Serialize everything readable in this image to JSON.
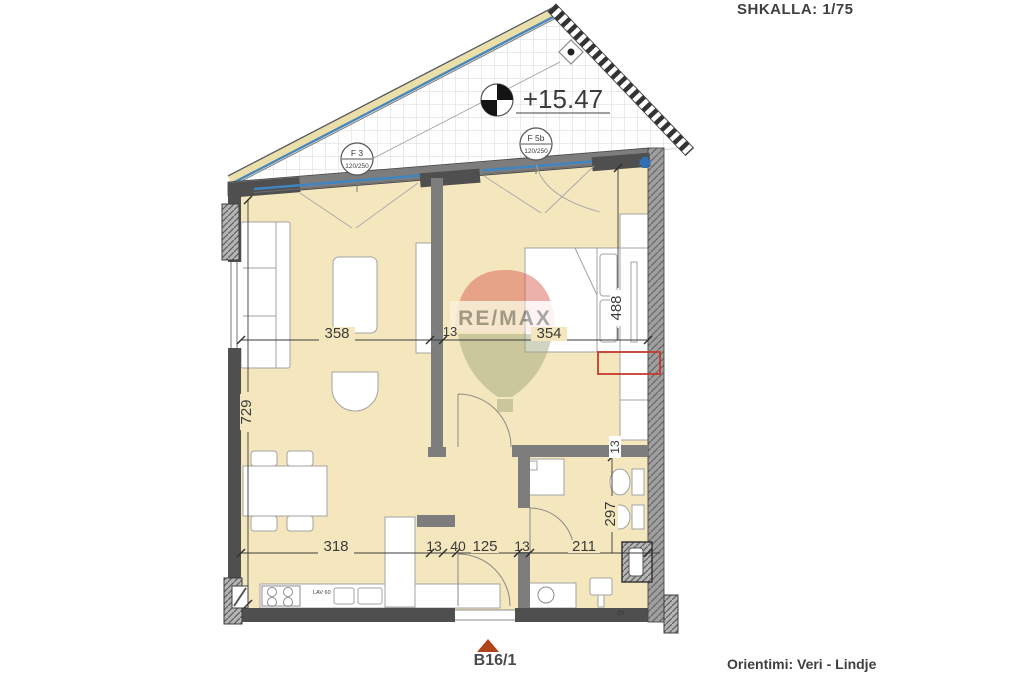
{
  "header": {
    "scale_label": "SHKALLA: 1/75"
  },
  "plan": {
    "elevation_label": "+15.47",
    "window_tags": [
      {
        "name": "F 3",
        "size": "120/250"
      },
      {
        "name": "F 5b",
        "size": "120/250"
      }
    ],
    "kitchen_counter_label": "LAV 60",
    "dimensions": {
      "upper_row": [
        "358",
        "13",
        "354"
      ],
      "lower_row": [
        "318",
        "13",
        "40",
        "125",
        "13",
        "211"
      ],
      "left_vertical": "729",
      "right_vertical_upper": "488",
      "right_vertical_lower": "297",
      "bath_wall_thickness": "13",
      "corner_detail": "9"
    }
  },
  "watermark": {
    "brand": "RE/MAX"
  },
  "footer": {
    "unit_label": "B16/1",
    "orientation_label": "Orientimi: Veri - Lindje"
  },
  "colors": {
    "floor_fill": "#f4e7bd",
    "wall_dark": "#4f4f4f",
    "wall_mid": "#7d7d7d",
    "window_blue": "#3f86c0",
    "highlight_red": "#c43a2e",
    "entrance_marker": "#b0441c"
  }
}
